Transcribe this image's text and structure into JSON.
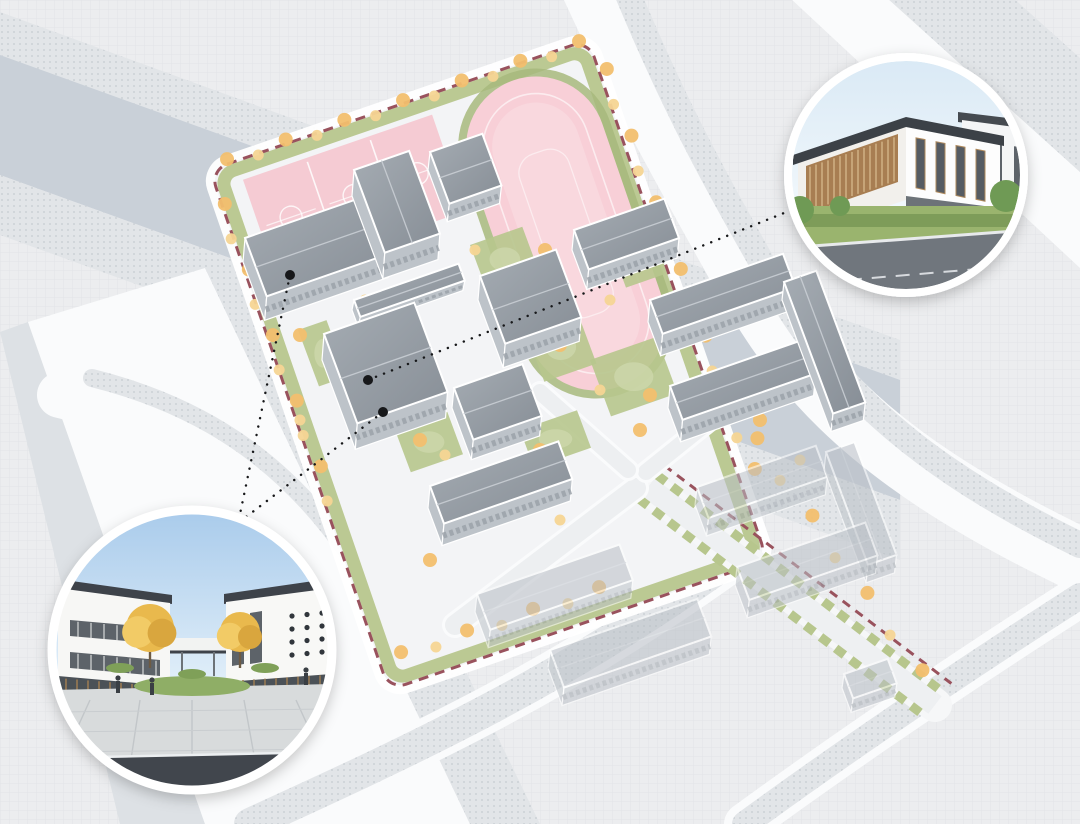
{
  "page": {
    "title": "campus-masterplan-rendering",
    "width": 1080,
    "height": 824
  },
  "palette": {
    "background": "#ecedef",
    "grid_line": "#d8dbdf",
    "road_band": "#c9d0d8",
    "road_dotted_base": "#e2e5e8",
    "road_dotted_dot": "#c6cbd1",
    "road_white": "#fafbfc",
    "site_ground": "#f3f4f6",
    "green": "#b7c68d",
    "green_dark": "#a7b97d",
    "tree_orange": "#f2bf6e",
    "tree_light": "#f6d593",
    "pink_track": "#f8cfd7",
    "pink_infield": "#f9d8de",
    "pink_courts": "#f5cbd3",
    "roof_light": "#a5acb3",
    "roof_dark": "#878e96",
    "roof_context": "#b9bfc6",
    "wall": "#bdc3c9",
    "boundary_red": "#99525d",
    "connector_black": "#17181a",
    "white": "#ffffff"
  },
  "map_data": {
    "site": {
      "origin": [
        210,
        170
      ],
      "rotation_deg": -19,
      "width": 400,
      "height": 550,
      "corner_radius": 18,
      "courts": {
        "x": 28,
        "y": 20,
        "w": 200,
        "h": 102,
        "count": 3
      },
      "track": {
        "apron": [
          238,
          6,
          156,
          340
        ],
        "outer": [
          246,
          14,
          140,
          324
        ],
        "lane": [
          263,
          31,
          106,
          290
        ],
        "infield": [
          272,
          40,
          88,
          272
        ]
      }
    },
    "buildings": [
      {
        "id": "gymnasium",
        "anchor": [
          243,
          262
        ],
        "a": 130,
        "b": 62,
        "h": 24
      },
      {
        "id": "teaching-block-a",
        "anchor": [
          352,
          196
        ],
        "a": 58,
        "b": 88,
        "h": 26
      },
      {
        "id": "teaching-block-b",
        "anchor": [
          428,
          170
        ],
        "a": 55,
        "b": 55,
        "h": 18
      },
      {
        "id": "link-corridor",
        "anchor": [
          352,
          310
        ],
        "a": 110,
        "b": 18,
        "h": 10
      },
      {
        "id": "teaching-block-c",
        "anchor": [
          322,
          360
        ],
        "a": 95,
        "b": 95,
        "h": 26
      },
      {
        "id": "auditorium",
        "anchor": [
          478,
          300
        ],
        "a": 80,
        "b": 72,
        "h": 24
      },
      {
        "id": "lab-block",
        "anchor": [
          452,
          408
        ],
        "a": 72,
        "b": 55,
        "h": 20
      },
      {
        "id": "east-slab",
        "anchor": [
          572,
          250
        ],
        "a": 95,
        "b": 42,
        "h": 20
      },
      {
        "id": "dormitory-north",
        "anchor": [
          648,
          322
        ],
        "a": 140,
        "b": 36,
        "h": 22
      },
      {
        "id": "dormitory-south",
        "anchor": [
          668,
          408
        ],
        "a": 140,
        "b": 36,
        "h": 22
      },
      {
        "id": "dormitory-link",
        "anchor": [
          782,
          300
        ],
        "a": 34,
        "b": 140,
        "h": 18
      },
      {
        "id": "south-classroom",
        "anchor": [
          428,
          508
        ],
        "a": 135,
        "b": 40,
        "h": 22
      }
    ],
    "context_buildings": [
      {
        "id": "context-slab-1",
        "anchor": [
          475,
          612
        ],
        "a": 150,
        "b": 38,
        "h": 18
      },
      {
        "id": "context-slab-2",
        "anchor": [
          548,
          668
        ],
        "a": 155,
        "b": 40,
        "h": 18
      },
      {
        "id": "context-c-north",
        "anchor": [
          695,
          505
        ],
        "a": 125,
        "b": 33,
        "h": 18
      },
      {
        "id": "context-c-east",
        "anchor": [
          824,
          470
        ],
        "a": 30,
        "b": 120,
        "h": 18
      },
      {
        "id": "context-c-south",
        "anchor": [
          735,
          585
        ],
        "a": 135,
        "b": 35,
        "h": 18
      },
      {
        "id": "context-small",
        "anchor": [
          842,
          688
        ],
        "a": 46,
        "b": 26,
        "h": 14
      }
    ],
    "courtyards": [
      {
        "anchor": [
          330,
          230
        ],
        "a": 60,
        "b": 45
      },
      {
        "anchor": [
          470,
          245
        ],
        "a": 55,
        "b": 50
      },
      {
        "anchor": [
          525,
          330
        ],
        "a": 55,
        "b": 55
      },
      {
        "anchor": [
          590,
          360
        ],
        "a": 70,
        "b": 60
      },
      {
        "anchor": [
          395,
          430
        ],
        "a": 55,
        "b": 45
      },
      {
        "anchor": [
          520,
          430
        ],
        "a": 60,
        "b": 40
      },
      {
        "anchor": [
          612,
          250
        ],
        "a": 40,
        "b": 40
      },
      {
        "anchor": [
          298,
          330
        ],
        "a": 30,
        "b": 60
      }
    ],
    "tree_lines": [
      {
        "from": [
          228,
          162
        ],
        "to": [
          580,
          44
        ],
        "count": 13
      },
      {
        "from": [
          222,
          205
        ],
        "to": [
          330,
          500
        ],
        "count": 10
      },
      {
        "from": [
          604,
          70
        ],
        "to": [
          752,
          470
        ],
        "count": 13
      },
      {
        "from": [
          402,
          655
        ],
        "to": [
          600,
          590
        ],
        "count": 7
      },
      {
        "from": [
          755,
          440
        ],
        "to": [
          920,
          672
        ],
        "count": 7
      }
    ],
    "single_trees": [
      [
        335,
        232
      ],
      [
        410,
        225
      ],
      [
        300,
        335
      ],
      [
        475,
        250
      ],
      [
        545,
        250
      ],
      [
        520,
        330
      ],
      [
        560,
        345
      ],
      [
        600,
        390
      ],
      [
        650,
        395
      ],
      [
        610,
        300
      ],
      [
        420,
        440
      ],
      [
        445,
        455
      ],
      [
        540,
        450
      ],
      [
        560,
        470
      ],
      [
        500,
        300
      ],
      [
        365,
        300
      ],
      [
        640,
        430
      ],
      [
        700,
        390
      ],
      [
        480,
        490
      ],
      [
        560,
        520
      ],
      [
        430,
        560
      ],
      [
        300,
        420
      ],
      [
        760,
        420
      ],
      [
        800,
        460
      ]
    ],
    "avenue": {
      "from": [
        648,
        487
      ],
      "to": [
        935,
        705
      ]
    },
    "internal_roads": [
      {
        "from": [
          636,
          488
        ],
        "to": [
          455,
          625
        ],
        "w": 20
      },
      {
        "from": [
          646,
          472
        ],
        "to": [
          768,
          374
        ],
        "w": 16
      },
      {
        "from": [
          628,
          470
        ],
        "to": [
          540,
          392
        ],
        "w": 16
      }
    ]
  },
  "connectors": {
    "anchor_dots": [
      [
        290,
        275
      ],
      [
        368,
        380
      ],
      [
        383,
        412
      ]
    ],
    "lines": [
      {
        "from": [
          290,
          275
        ],
        "to": [
          240,
          514
        ]
      },
      {
        "from": [
          383,
          412
        ],
        "to": [
          246,
          517
        ]
      },
      {
        "from": [
          368,
          380
        ],
        "to": [
          794,
          209
        ]
      }
    ]
  },
  "callouts": [
    {
      "name": "entrance-plaza-rendering",
      "center": [
        192,
        650
      ],
      "radius": 140,
      "ring_width": 9,
      "subject": "courtyard entrance flanked by two white buildings with ginkgo trees"
    },
    {
      "name": "teaching-building-rendering",
      "center": [
        906,
        175
      ],
      "radius": 118,
      "ring_width": 8,
      "subject": "three-storey white teaching building with timber screen facade"
    }
  ]
}
